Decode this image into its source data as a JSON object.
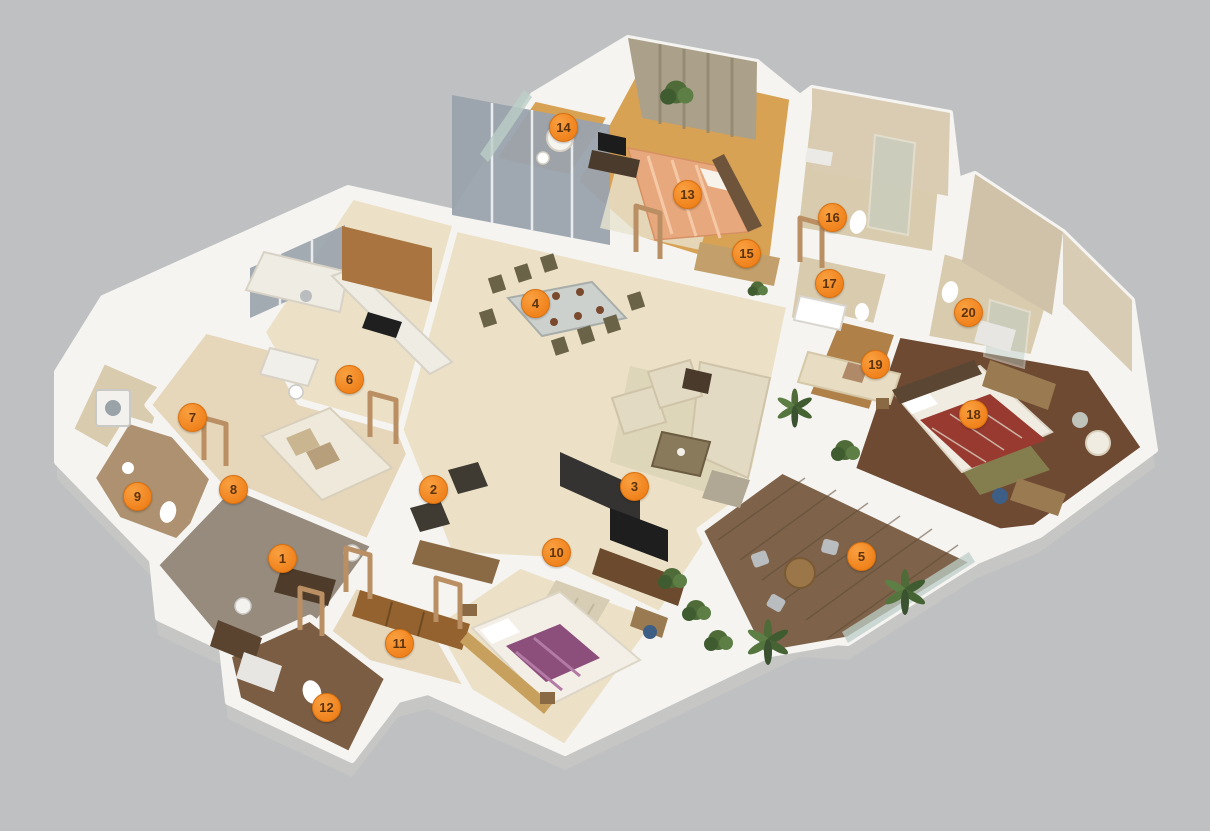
{
  "canvas": {
    "width": 1210,
    "height": 831
  },
  "colors": {
    "background": "#bec0c2",
    "wall": "#f5f4f1",
    "wall-shadow": "#c6c6c4",
    "marble": "#ece1c6",
    "marble-warm": "#e6d6ba",
    "wood-gold": "#d8a254",
    "wood-mid": "#b08049",
    "wood-dark": "#6e4a32",
    "deck": "#7e634a",
    "tile": "#d9cbae",
    "tile-dark": "#7b5d43",
    "tile-brown": "#ad9170",
    "foyer": "#968b7d",
    "glass": "#bccec7",
    "window": "#9aa3ad",
    "curtain": "#aba089",
    "plant": "#4e6b38",
    "marker-fill": "#f0821c",
    "marker-border": "#d9700e",
    "marker-text": "#5d330e"
  },
  "markers": [
    {
      "n": "1",
      "x": 23.31,
      "y": 67.15
    },
    {
      "n": "2",
      "x": 35.79,
      "y": 58.84
    },
    {
      "n": "3",
      "x": 52.4,
      "y": 58.48
    },
    {
      "n": "4",
      "x": 44.21,
      "y": 36.46
    },
    {
      "n": "5",
      "x": 71.16,
      "y": 66.91
    },
    {
      "n": "6",
      "x": 28.84,
      "y": 45.61
    },
    {
      "n": "7",
      "x": 15.87,
      "y": 50.18
    },
    {
      "n": "8",
      "x": 19.26,
      "y": 58.84
    },
    {
      "n": "9",
      "x": 11.32,
      "y": 59.69
    },
    {
      "n": "10",
      "x": 45.95,
      "y": 66.43
    },
    {
      "n": "11",
      "x": 32.98,
      "y": 77.38
    },
    {
      "n": "12",
      "x": 26.94,
      "y": 85.08
    },
    {
      "n": "13",
      "x": 56.78,
      "y": 23.35
    },
    {
      "n": "14",
      "x": 46.53,
      "y": 15.28
    },
    {
      "n": "15",
      "x": 61.65,
      "y": 30.45
    },
    {
      "n": "16",
      "x": 68.76,
      "y": 26.11
    },
    {
      "n": "17",
      "x": 68.51,
      "y": 34.06
    },
    {
      "n": "18",
      "x": 80.41,
      "y": 49.82
    },
    {
      "n": "19",
      "x": 72.31,
      "y": 43.8
    },
    {
      "n": "20",
      "x": 80.0,
      "y": 37.55
    }
  ]
}
